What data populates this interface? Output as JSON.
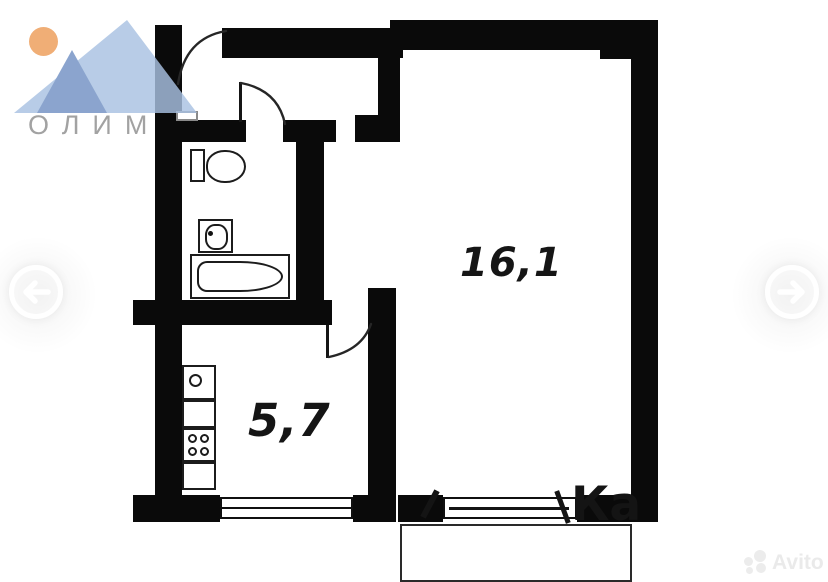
{
  "page": {
    "background_color": "#ffffff"
  },
  "brand_logo": {
    "text": "ОЛИМП",
    "sun_color": "#F0AE76",
    "mountain_back_color": "#A9C2E2",
    "mountain_front_color": "#7291C4",
    "text_color": "#A2A2A2"
  },
  "floorplan": {
    "wall_color": "#0a0a0a",
    "room_labels": {
      "living_room_area": "16,1",
      "kitchen_area": "5,7"
    },
    "fixture_names": [
      "toilet",
      "wash-basin",
      "bathtub",
      "kitchen-sink",
      "countertop",
      "stove",
      "cabinet"
    ],
    "feature_names": [
      "entrance-door-swing",
      "bathroom-door-swing",
      "kitchen-door-swing",
      "kitchen-window",
      "living-room-window",
      "balcony",
      "wall-vent"
    ]
  },
  "photo_carousel": {
    "prev_icon": "arrow-left",
    "next_icon": "arrow-right"
  },
  "watermarks": {
    "center_fragment_text": "Ка",
    "corner_brand_text": "Avito"
  }
}
